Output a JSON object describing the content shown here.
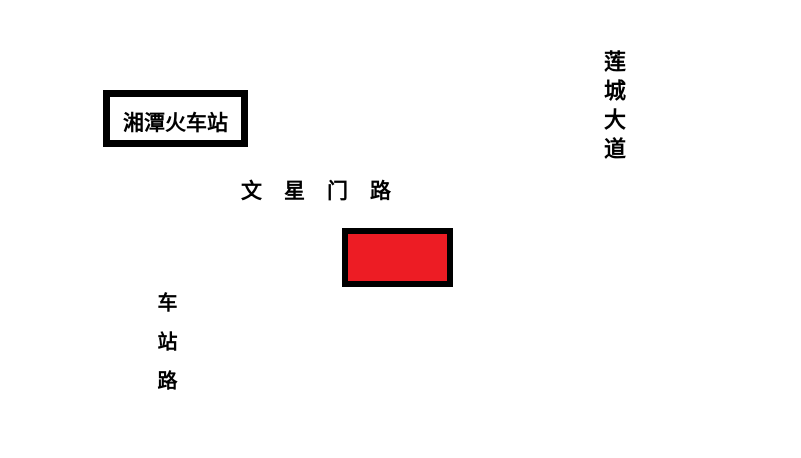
{
  "map": {
    "background_color": "#FFFFFF",
    "road_line_color": "#000000",
    "text_color": "#000000",
    "station_box": {
      "label": "湘潭火车站"
    },
    "roads": {
      "wenxingmen": {
        "label": "文星门路"
      },
      "liancheng": {
        "label": "莲城大道"
      },
      "chezhan": {
        "label": "车站路"
      }
    },
    "marker": {
      "color": "#ED1C24"
    }
  }
}
